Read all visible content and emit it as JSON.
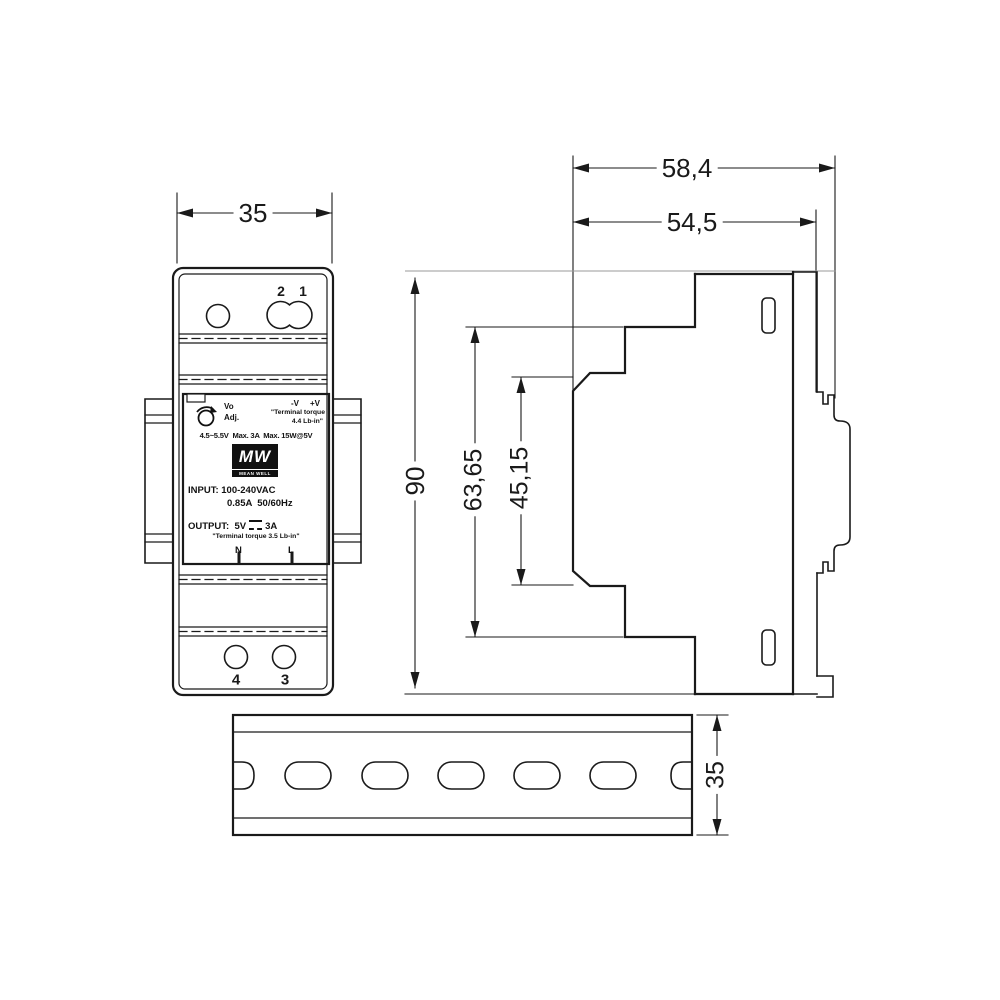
{
  "meta": {
    "units": "mm",
    "drawing_type": "mechanical-dimension-drawing"
  },
  "colors": {
    "line": "#1a1a1a",
    "light_line": "#9a9a9a",
    "bg": "#ffffff"
  },
  "front_view": {
    "width_dim": "35",
    "top_terminals": {
      "hole2": "2",
      "hole1": "1"
    },
    "bottom_terminals": {
      "hole4": "4",
      "hole3": "3"
    },
    "label": {
      "vo": "Vo",
      "adj": "Adj.",
      "neg": "-V",
      "pos": "+V",
      "torque_line1": "\"Terminal torque",
      "torque_line2": "4.4 Lb-in\"",
      "spec": "4.5~5.5V  Max. 3A  Max. 15W@5V",
      "logo_mw": "MW",
      "logo_brand": "MEAN WELL",
      "input_line1": "INPUT: 100-240VAC",
      "input_line2": "0.85A  50/60Hz",
      "output_prefix": "OUTPUT:  5V",
      "output_current": "3A",
      "torque_bottom": "\"Terminal torque 3.5 Lb-in\"",
      "terminal_n": "N",
      "terminal_l": "L"
    }
  },
  "side_view": {
    "depth_overall": "58,4",
    "depth_body": "54,5",
    "height_overall": "90",
    "height_upper": "63,65",
    "height_inner": "45,15"
  },
  "din_rail": {
    "height_dim": "35"
  }
}
